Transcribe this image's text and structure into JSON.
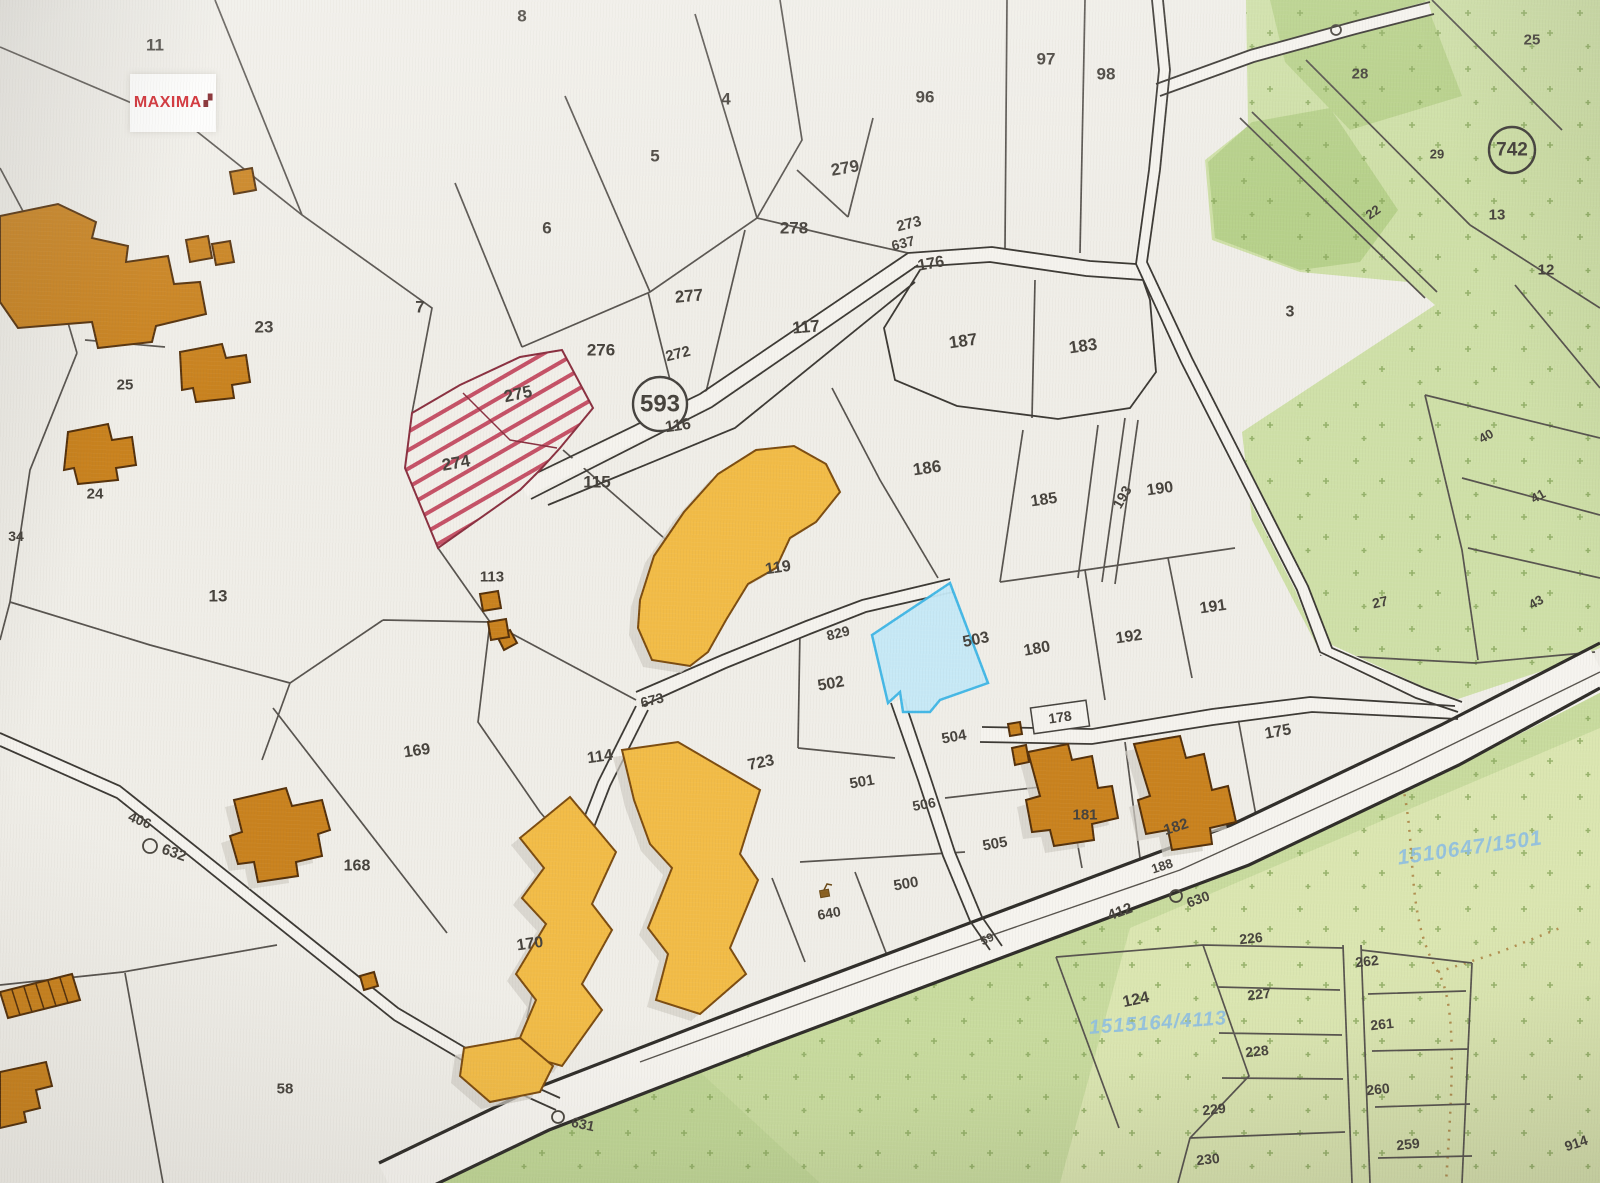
{
  "logo": {
    "text": "MAXIMA",
    "mark": "▞"
  },
  "map": {
    "type": "cadastral-parcel-map",
    "highlighted_parcel": "503",
    "hatched_parcels": [
      "274",
      "275"
    ],
    "circled_road_numbers": [
      "593",
      "742"
    ],
    "colors": {
      "highlight_fill": "#c5e9f7",
      "highlight_border": "#3cb6e6",
      "hatch_red": "#c04058",
      "building_orange": "#c9821e",
      "building_gold": "#f2bc47",
      "forest_green": "#cfe0a8",
      "logo_red": "#cf1f26",
      "watermark_blue": "#8ebfe2"
    }
  },
  "labels": [
    {
      "t": "11",
      "x": 155,
      "y": 45,
      "r": 0,
      "s": 17
    },
    {
      "t": "8",
      "x": 522,
      "y": 16,
      "r": 0,
      "s": 17
    },
    {
      "t": "4",
      "x": 726,
      "y": 99,
      "r": 0,
      "s": 17
    },
    {
      "t": "96",
      "x": 925,
      "y": 97,
      "r": 0,
      "s": 17
    },
    {
      "t": "97",
      "x": 1046,
      "y": 59,
      "r": 0,
      "s": 17
    },
    {
      "t": "98",
      "x": 1106,
      "y": 74,
      "r": 0,
      "s": 17
    },
    {
      "t": "5",
      "x": 655,
      "y": 156,
      "r": 0,
      "s": 17
    },
    {
      "t": "279",
      "x": 845,
      "y": 168,
      "r": -10,
      "s": 17
    },
    {
      "t": "25",
      "x": 1532,
      "y": 40,
      "r": 0,
      "s": 15,
      "n": "label-25-ne"
    },
    {
      "t": "28",
      "x": 1360,
      "y": 74,
      "r": 0,
      "s": 15
    },
    {
      "t": "29",
      "x": 1437,
      "y": 154,
      "r": 0,
      "s": 13
    },
    {
      "t": "742",
      "x": 1512,
      "y": 150,
      "r": 0,
      "s": 19,
      "circ": 23
    },
    {
      "t": "22",
      "x": 1373,
      "y": 212,
      "r": -35,
      "s": 13
    },
    {
      "t": "13",
      "x": 1497,
      "y": 215,
      "r": 0,
      "s": 15,
      "n": "label-13-ne"
    },
    {
      "t": "12",
      "x": 1546,
      "y": 270,
      "r": 0,
      "s": 15
    },
    {
      "t": "6",
      "x": 547,
      "y": 228,
      "r": 0,
      "s": 17
    },
    {
      "t": "278",
      "x": 794,
      "y": 228,
      "r": 0,
      "s": 17
    },
    {
      "t": "273",
      "x": 909,
      "y": 224,
      "r": -14,
      "s": 15
    },
    {
      "t": "637",
      "x": 903,
      "y": 243,
      "r": -14,
      "s": 14
    },
    {
      "t": "176",
      "x": 931,
      "y": 264,
      "r": -10,
      "s": 16
    },
    {
      "t": "7",
      "x": 420,
      "y": 307,
      "r": 0,
      "s": 17
    },
    {
      "t": "23",
      "x": 264,
      "y": 327,
      "r": 0,
      "s": 17
    },
    {
      "t": "277",
      "x": 689,
      "y": 296,
      "r": -5,
      "s": 17
    },
    {
      "t": "117",
      "x": 806,
      "y": 327,
      "r": -5,
      "s": 17
    },
    {
      "t": "187",
      "x": 963,
      "y": 341,
      "r": -8,
      "s": 17
    },
    {
      "t": "183",
      "x": 1083,
      "y": 346,
      "r": -8,
      "s": 17
    },
    {
      "t": "3",
      "x": 1290,
      "y": 312,
      "r": 0,
      "s": 16
    },
    {
      "t": "276",
      "x": 601,
      "y": 350,
      "r": 0,
      "s": 17
    },
    {
      "t": "272",
      "x": 678,
      "y": 354,
      "r": -14,
      "s": 15
    },
    {
      "t": "275",
      "x": 518,
      "y": 394,
      "r": -12,
      "s": 17
    },
    {
      "t": "593",
      "x": 660,
      "y": 404,
      "r": 0,
      "s": 24,
      "circ": 27,
      "cf": "#f1efe9"
    },
    {
      "t": "116",
      "x": 678,
      "y": 426,
      "r": -8,
      "s": 16
    },
    {
      "t": "25",
      "x": 125,
      "y": 385,
      "r": 0,
      "s": 15,
      "n": "label-25-w"
    },
    {
      "t": "274",
      "x": 456,
      "y": 463,
      "r": -10,
      "s": 17
    },
    {
      "t": "115",
      "x": 597,
      "y": 482,
      "r": 0,
      "s": 17
    },
    {
      "t": "186",
      "x": 927,
      "y": 468,
      "r": -8,
      "s": 17
    },
    {
      "t": "185",
      "x": 1044,
      "y": 500,
      "r": -8,
      "s": 16
    },
    {
      "t": "193",
      "x": 1122,
      "y": 497,
      "r": -60,
      "s": 14
    },
    {
      "t": "190",
      "x": 1160,
      "y": 489,
      "r": -8,
      "s": 16
    },
    {
      "t": "24",
      "x": 95,
      "y": 494,
      "r": 0,
      "s": 15
    },
    {
      "t": "34",
      "x": 16,
      "y": 536,
      "r": 0,
      "s": 14
    },
    {
      "t": "40",
      "x": 1486,
      "y": 436,
      "r": -30,
      "s": 13
    },
    {
      "t": "41",
      "x": 1538,
      "y": 496,
      "r": -30,
      "s": 13
    },
    {
      "t": "43",
      "x": 1536,
      "y": 602,
      "r": -30,
      "s": 13
    },
    {
      "t": "27",
      "x": 1380,
      "y": 602,
      "r": -12,
      "s": 14
    },
    {
      "t": "191",
      "x": 1213,
      "y": 607,
      "r": -8,
      "s": 16
    },
    {
      "t": "13",
      "x": 218,
      "y": 596,
      "r": 0,
      "s": 17,
      "n": "label-13-w"
    },
    {
      "t": "113",
      "x": 492,
      "y": 577,
      "r": 0,
      "s": 15
    },
    {
      "t": "119",
      "x": 778,
      "y": 568,
      "r": -8,
      "s": 16
    },
    {
      "t": "829",
      "x": 838,
      "y": 633,
      "r": -14,
      "s": 14
    },
    {
      "t": "192",
      "x": 1129,
      "y": 637,
      "r": -8,
      "s": 16
    },
    {
      "t": "180",
      "x": 1037,
      "y": 649,
      "r": -10,
      "s": 16
    },
    {
      "t": "503",
      "x": 976,
      "y": 640,
      "r": -12,
      "s": 16,
      "n": "label-503-selected"
    },
    {
      "t": "502",
      "x": 831,
      "y": 684,
      "r": -10,
      "s": 16
    },
    {
      "t": "673",
      "x": 652,
      "y": 700,
      "r": -14,
      "s": 14
    },
    {
      "t": "178",
      "x": 1060,
      "y": 717,
      "r": -8,
      "s": 14
    },
    {
      "t": "175",
      "x": 1278,
      "y": 732,
      "r": -10,
      "s": 16
    },
    {
      "t": "169",
      "x": 417,
      "y": 751,
      "r": -8,
      "s": 16
    },
    {
      "t": "114",
      "x": 600,
      "y": 757,
      "r": -8,
      "s": 16
    },
    {
      "t": "723",
      "x": 761,
      "y": 763,
      "r": -12,
      "s": 16
    },
    {
      "t": "504",
      "x": 954,
      "y": 737,
      "r": -10,
      "s": 15
    },
    {
      "t": "501",
      "x": 862,
      "y": 782,
      "r": -10,
      "s": 15
    },
    {
      "t": "506",
      "x": 924,
      "y": 804,
      "r": -10,
      "s": 14
    },
    {
      "t": "505",
      "x": 995,
      "y": 844,
      "r": -10,
      "s": 15
    },
    {
      "t": "168",
      "x": 357,
      "y": 866,
      "r": 0,
      "s": 16
    },
    {
      "t": "181",
      "x": 1085,
      "y": 815,
      "r": 0,
      "s": 15
    },
    {
      "t": "182",
      "x": 1176,
      "y": 827,
      "r": -18,
      "s": 15
    },
    {
      "t": "188",
      "x": 1162,
      "y": 866,
      "r": -18,
      "s": 13
    },
    {
      "t": "500",
      "x": 906,
      "y": 884,
      "r": -10,
      "s": 15
    },
    {
      "t": "640",
      "x": 829,
      "y": 913,
      "r": -10,
      "s": 14
    },
    {
      "t": "59",
      "x": 987,
      "y": 939,
      "r": -25,
      "s": 12
    },
    {
      "t": "58",
      "x": 285,
      "y": 1089,
      "r": 0,
      "s": 15
    },
    {
      "t": "170",
      "x": 530,
      "y": 944,
      "r": -8,
      "s": 16
    },
    {
      "t": "406",
      "x": 140,
      "y": 820,
      "r": 22,
      "s": 14
    },
    {
      "t": "632",
      "x": 174,
      "y": 853,
      "r": 20,
      "s": 15
    },
    {
      "t": "412",
      "x": 1120,
      "y": 912,
      "r": -20,
      "s": 15
    },
    {
      "t": "630",
      "x": 1198,
      "y": 899,
      "r": -20,
      "s": 14
    },
    {
      "t": "631",
      "x": 583,
      "y": 1124,
      "r": 12,
      "s": 14
    },
    {
      "t": "226",
      "x": 1251,
      "y": 938,
      "r": -6,
      "s": 14
    },
    {
      "t": "227",
      "x": 1259,
      "y": 994,
      "r": -6,
      "s": 14
    },
    {
      "t": "262",
      "x": 1367,
      "y": 961,
      "r": -6,
      "s": 14
    },
    {
      "t": "261",
      "x": 1382,
      "y": 1024,
      "r": -6,
      "s": 14
    },
    {
      "t": "228",
      "x": 1257,
      "y": 1051,
      "r": -6,
      "s": 14
    },
    {
      "t": "260",
      "x": 1378,
      "y": 1089,
      "r": -6,
      "s": 14
    },
    {
      "t": "229",
      "x": 1214,
      "y": 1109,
      "r": -6,
      "s": 14
    },
    {
      "t": "259",
      "x": 1408,
      "y": 1144,
      "r": -6,
      "s": 14
    },
    {
      "t": "230",
      "x": 1208,
      "y": 1159,
      "r": -6,
      "s": 14
    },
    {
      "t": "124",
      "x": 1136,
      "y": 1000,
      "r": -12,
      "s": 16
    },
    {
      "t": "914",
      "x": 1576,
      "y": 1143,
      "r": -18,
      "s": 14
    },
    {
      "t": "1510647/1501",
      "x": 1470,
      "y": 848,
      "r": -8,
      "s": 21,
      "c": "#8ebfe2",
      "o": 0.9,
      "ls": 1,
      "i": 1,
      "n": "watermark-id-1"
    },
    {
      "t": "1515164/4113",
      "x": 1158,
      "y": 1023,
      "r": -4,
      "s": 20,
      "c": "#8ebfe2",
      "o": 0.9,
      "ls": 1,
      "i": 1,
      "n": "watermark-id-2"
    }
  ],
  "symbols": [
    {
      "type": "circle",
      "x": 150,
      "y": 846,
      "rr": 7,
      "name": "spring-circle-symbol-632"
    },
    {
      "type": "circle",
      "x": 1176,
      "y": 896,
      "rr": 6,
      "name": "spring-circle-symbol-630"
    },
    {
      "type": "circle",
      "x": 558,
      "y": 1117,
      "rr": 6,
      "name": "spring-circle-symbol-631"
    },
    {
      "type": "circle",
      "x": 1336,
      "y": 30,
      "rr": 5,
      "name": "spring-circle-symbol-ne"
    }
  ]
}
